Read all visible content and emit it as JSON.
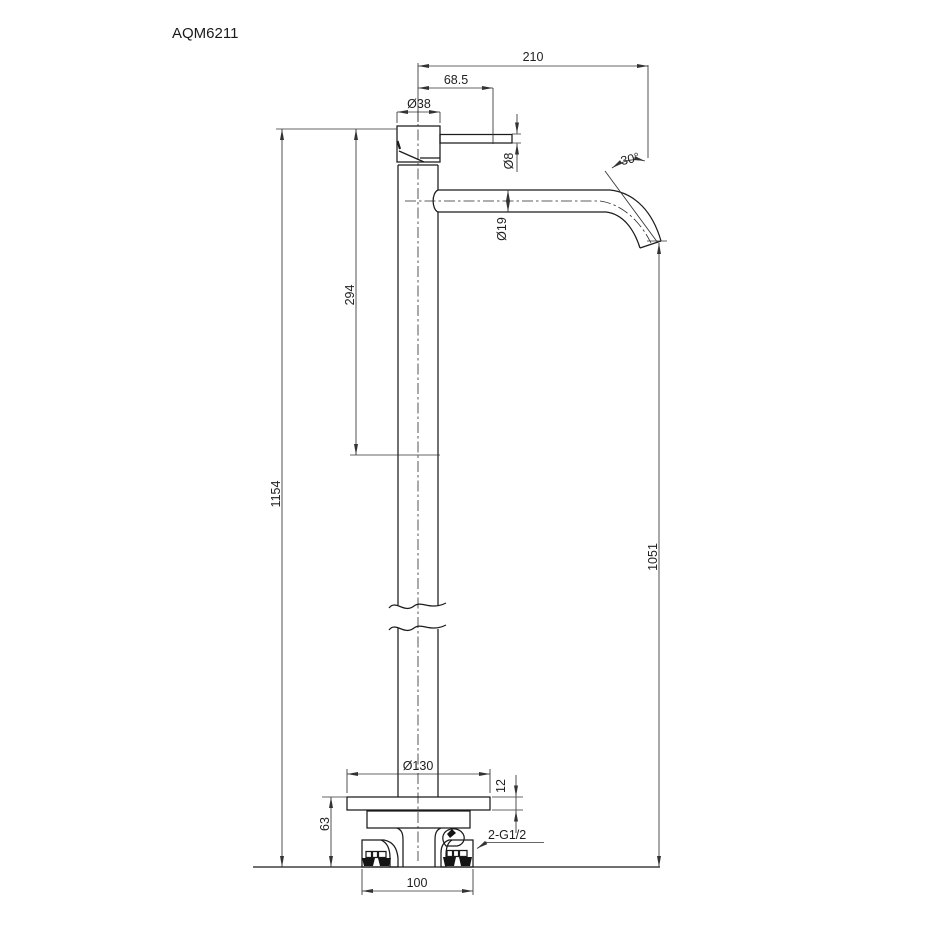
{
  "title": "AQM6211",
  "drawing": {
    "type": "technical dimension drawing, front elevation of freestanding faucet",
    "dimensions": {
      "spout_reach": "210",
      "handle_length": "68.5",
      "body_diameter": "Ø38",
      "handle_diameter": "Ø8",
      "spout_angle": "30°",
      "spout_diameter": "Ø19",
      "upper_body_height": "294",
      "total_height": "1154",
      "spout_outlet_height": "1051",
      "base_plate_diameter": "Ø130",
      "base_plate_thickness": "12",
      "base_height": "63",
      "inlet_width": "100",
      "inlet_thread": "2-G1/2"
    }
  }
}
